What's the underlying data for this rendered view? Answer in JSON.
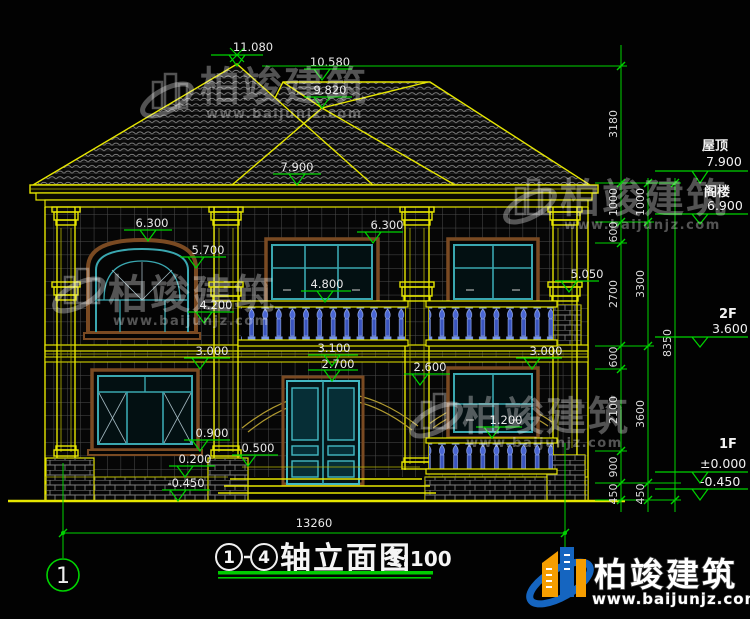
{
  "drawing": {
    "title": "轴立面图",
    "axis_start": "1",
    "axis_end": "4",
    "scale": "1:100",
    "axis_bubble": "1",
    "total_width": "13260"
  },
  "elevation_markers": [
    "11.080",
    "10.580",
    "9.820",
    "7.900",
    "6.300",
    "5.700",
    "6.300",
    "4.800",
    "5.050",
    "4.200",
    "3.000",
    "3.100",
    "2.700",
    "2.600",
    "3.000",
    "1.200",
    "0.900",
    "0.500",
    "0.200",
    "-0.450"
  ],
  "right_markers": {
    "roof_label": "屋顶",
    "roof_level": "7.900",
    "attic_label": "阁楼",
    "attic_level": "6.900",
    "f2_label": "2F",
    "f2_level": "3.600",
    "f1_label": "1F",
    "f1_zero": "±0.000",
    "f1_minus": "-0.450"
  },
  "dim_chains": {
    "inner": [
      "3180",
      "1000",
      "600",
      "2700",
      "600",
      "2100",
      "900",
      "450"
    ],
    "middle": [
      "1000",
      "3300",
      "3600",
      "450"
    ],
    "outer": [
      "8350"
    ]
  },
  "watermark": {
    "brand": "柏竣建筑",
    "url": "www.baijunjz.com"
  },
  "colors": {
    "line_yellow": "#e6e600",
    "dim_green": "#00d400",
    "frame_teal": "#3aa7b0",
    "trim_brown": "#7a4a22",
    "baluster_blue": "#5577dd",
    "logo_blue": "#1565c0",
    "logo_orange": "#f59d00"
  }
}
